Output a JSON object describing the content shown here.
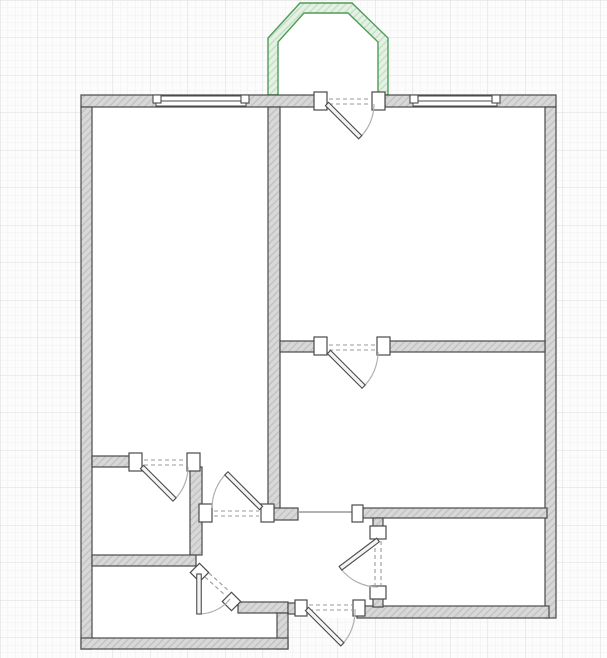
{
  "canvas": {
    "width": 607,
    "height": 658,
    "background": "#fcfcfc"
  },
  "grid": {
    "minor_step": 7.5,
    "major_step": 37.5,
    "minor_color": "#eeeeee",
    "major_color": "#dddddd"
  },
  "palette": {
    "wall_fill": "#d8d8d8",
    "wall_hatch": "#bfbfbf",
    "wall_stroke": "#4a4a4a",
    "floor": "#ffffff",
    "jamb_fill": "#ffffff",
    "leaf_fill": "#f4f4f4",
    "arc_color": "#b0b0b0",
    "dash_color": "#999999",
    "window_stroke": "#4a4a4a",
    "balcony_stroke": "#4e9d57",
    "balcony_fill": "#e4f1e4",
    "balcony_hatch": "#c2dcc4"
  },
  "floor_plan": {
    "footprint": [
      [
        81,
        95
      ],
      [
        556,
        95
      ],
      [
        556,
        618
      ],
      [
        288,
        618
      ],
      [
        288,
        649
      ],
      [
        81,
        649
      ]
    ],
    "balcony": {
      "name": "balcony",
      "outer": [
        [
          268,
          95
        ],
        [
          268,
          38
        ],
        [
          300,
          3
        ],
        [
          352,
          3
        ],
        [
          388,
          38
        ],
        [
          388,
          95
        ]
      ],
      "inner": [
        [
          278,
          95
        ],
        [
          278,
          42
        ],
        [
          304,
          13
        ],
        [
          348,
          13
        ],
        [
          378,
          42
        ],
        [
          378,
          95
        ]
      ]
    },
    "walls": [
      {
        "name": "wall-top-left",
        "x": 81,
        "y": 95,
        "w": 234,
        "h": 12
      },
      {
        "name": "wall-top-right",
        "x": 385,
        "y": 95,
        "w": 171,
        "h": 12
      },
      {
        "name": "wall-left",
        "x": 81,
        "y": 107,
        "w": 11,
        "h": 542
      },
      {
        "name": "wall-right",
        "x": 545,
        "y": 107,
        "w": 11,
        "h": 511
      },
      {
        "name": "wall-center-vertical",
        "x": 268,
        "y": 107,
        "w": 12,
        "h": 402
      },
      {
        "name": "wall-center-foot",
        "x": 268,
        "y": 508,
        "w": 30,
        "h": 12
      },
      {
        "name": "wall-divider-left",
        "x": 280,
        "y": 341,
        "w": 36,
        "h": 11
      },
      {
        "name": "wall-divider-right",
        "x": 389,
        "y": 341,
        "w": 156,
        "h": 11
      },
      {
        "name": "wall-storage-top",
        "x": 92,
        "y": 456,
        "w": 39,
        "h": 11
      },
      {
        "name": "wall-storage-right",
        "x": 190,
        "y": 467,
        "w": 12,
        "h": 88
      },
      {
        "name": "wall-storage-bottom",
        "x": 92,
        "y": 555,
        "w": 104,
        "h": 11
      },
      {
        "name": "wall-kitchen-top-right",
        "x": 238,
        "y": 602,
        "w": 50,
        "h": 11
      },
      {
        "name": "wall-kitchen-right",
        "x": 277,
        "y": 613,
        "w": 11,
        "h": 36
      },
      {
        "name": "wall-bottom-left",
        "x": 81,
        "y": 638,
        "w": 207,
        "h": 11
      },
      {
        "name": "wall-entry-stub",
        "x": 288,
        "y": 603,
        "w": 9,
        "h": 11
      },
      {
        "name": "wall-bottom-right",
        "x": 357,
        "y": 606,
        "w": 192,
        "h": 12
      },
      {
        "name": "wall-bath-top",
        "x": 357,
        "y": 508,
        "w": 190,
        "h": 10
      },
      {
        "name": "wall-bath-left-upper",
        "x": 373,
        "y": 518,
        "w": 10,
        "h": 11
      },
      {
        "name": "wall-bath-left-lower",
        "x": 373,
        "y": 597,
        "w": 10,
        "h": 10
      }
    ],
    "passage_line": {
      "name": "open-passage",
      "x1": 298,
      "y1": 512,
      "x2": 357,
      "y2": 512
    },
    "windows": [
      {
        "name": "window-left",
        "x": 156,
        "y": 96,
        "w": 90,
        "h": 10
      },
      {
        "name": "window-right",
        "x": 413,
        "y": 96,
        "w": 84,
        "h": 10
      }
    ],
    "jambs": [
      {
        "name": "balcony-door-jamb-left",
        "x": 314,
        "y": 92,
        "w": 13,
        "h": 18
      },
      {
        "name": "balcony-door-jamb-right",
        "x": 372,
        "y": 92,
        "w": 13,
        "h": 18
      },
      {
        "name": "divider-door-jamb-left",
        "x": 314,
        "y": 337,
        "w": 13,
        "h": 18
      },
      {
        "name": "divider-door-jamb-right",
        "x": 377,
        "y": 337,
        "w": 13,
        "h": 18
      },
      {
        "name": "storage-door-jamb-left",
        "x": 129,
        "y": 453,
        "w": 13,
        "h": 18
      },
      {
        "name": "storage-door-jamb-right",
        "x": 187,
        "y": 453,
        "w": 13,
        "h": 18
      },
      {
        "name": "hall-door-jamb-left",
        "x": 199,
        "y": 504,
        "w": 13,
        "h": 18
      },
      {
        "name": "hall-door-jamb-right",
        "x": 261,
        "y": 504,
        "w": 13,
        "h": 18
      },
      {
        "name": "passage-jamb",
        "x": 352,
        "y": 505,
        "w": 11,
        "h": 17
      },
      {
        "name": "bath-door-jamb-top",
        "x": 370,
        "y": 526,
        "w": 16,
        "h": 13
      },
      {
        "name": "bath-door-jamb-bottom",
        "x": 370,
        "y": 586,
        "w": 16,
        "h": 13
      },
      {
        "name": "entry-door-jamb-left",
        "x": 295,
        "y": 600,
        "w": 12,
        "h": 16
      },
      {
        "name": "entry-door-jamb-right",
        "x": 353,
        "y": 600,
        "w": 12,
        "h": 16
      },
      {
        "name": "kitchen-door-jamb-top",
        "x": 193,
        "y": 566,
        "w": 13,
        "h": 13,
        "rot": 45
      },
      {
        "name": "kitchen-door-jamb-bottom",
        "x": 225,
        "y": 595,
        "w": 13,
        "h": 13,
        "rot": 45
      }
    ],
    "doors": [
      {
        "name": "balcony-door",
        "hinge": [
          327,
          104
        ],
        "angle": 45,
        "length": 47,
        "arc_from": [
          374,
          104
        ],
        "sweep": 1,
        "dashes": [
          [
            329,
            99,
            372,
            99
          ],
          [
            329,
            104,
            372,
            104
          ]
        ]
      },
      {
        "name": "divider-door",
        "hinge": [
          329,
          352
        ],
        "angle": 45,
        "length": 49,
        "arc_from": [
          378,
          352
        ],
        "sweep": 1,
        "dashes": [
          [
            329,
            345,
            377,
            345
          ],
          [
            329,
            350,
            377,
            350
          ]
        ]
      },
      {
        "name": "storage-door",
        "hinge": [
          142,
          467
        ],
        "angle": 45,
        "length": 46,
        "arc_from": [
          188,
          467
        ],
        "sweep": 1,
        "dashes": [
          [
            144,
            460,
            187,
            460
          ],
          [
            144,
            465,
            187,
            465
          ]
        ]
      },
      {
        "name": "hall-door",
        "hinge": [
          261,
          508
        ],
        "angle": -135,
        "length": 49,
        "arc_from": [
          212,
          508
        ],
        "sweep": 1,
        "dashes": [
          [
            214,
            511,
            259,
            511
          ],
          [
            214,
            516,
            259,
            516
          ]
        ]
      },
      {
        "name": "bath-door",
        "hinge": [
          378,
          540
        ],
        "angle": 143,
        "length": 47,
        "arc_from": [
          378,
          587
        ],
        "sweep": 1,
        "dashes": [
          [
            375,
            541,
            375,
            586
          ],
          [
            381,
            541,
            381,
            586
          ]
        ]
      },
      {
        "name": "entry-door",
        "hinge": [
          307,
          609
        ],
        "angle": 45,
        "length": 50,
        "arc_from": [
          355,
          609
        ],
        "sweep": 1,
        "dashes": [
          [
            309,
            605,
            352,
            605
          ],
          [
            309,
            610,
            352,
            610
          ]
        ]
      },
      {
        "name": "kitchen-door",
        "hinge": [
          199,
          574
        ],
        "angle": 90,
        "length": 40,
        "arc_from": [
          230,
          599
        ],
        "sweep": 1,
        "dashes": [
          [
            205,
            577,
            226,
            596
          ],
          [
            209,
            573,
            230,
            592
          ]
        ]
      }
    ]
  }
}
